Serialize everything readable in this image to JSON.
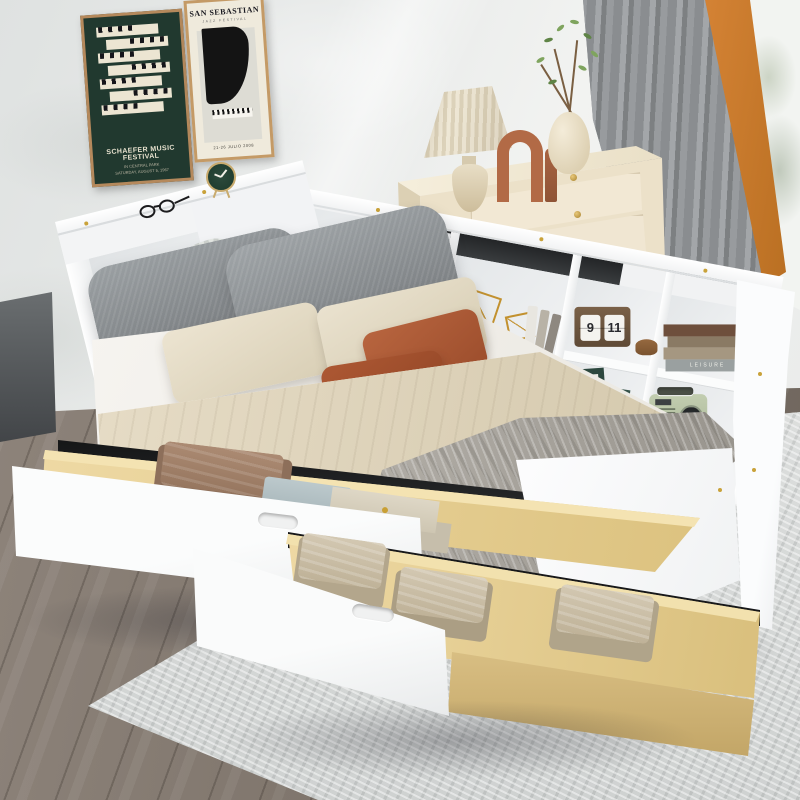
{
  "posters": {
    "schaefer": {
      "title": "SCHAEFER MUSIC FESTIVAL",
      "line2": "IN CENTRAL PARK",
      "line3": "SATURDAY, AUGUST 5, 1967"
    },
    "san_sebastian": {
      "title": "SAN SEBASTIAN",
      "subtitle": "JAZZ FESTIVAL",
      "date": "21-26 JULIO 2008"
    }
  },
  "shelf": {
    "flip_calendar": {
      "month": "9",
      "day": "11"
    },
    "books": {
      "finance": "FINANCE",
      "architecture": "ARCHITECTURE",
      "leisure": "LEISURE"
    }
  },
  "palette": {
    "bed_frame_white": "#fbfcfd",
    "poster_green": "#21392f",
    "window_frame_orange": "#c8772a",
    "curtain_gray": "#909396",
    "dresser_cream": "#ece1c9",
    "accent_terracotta": "#a8522f",
    "radio_sage": "#b8c4a4",
    "hardware_gold": "#c9a23a",
    "drawer_wood": "#e5cf9a",
    "floor_wood": "#7e746b",
    "rug_gray": "#d8dad9"
  }
}
